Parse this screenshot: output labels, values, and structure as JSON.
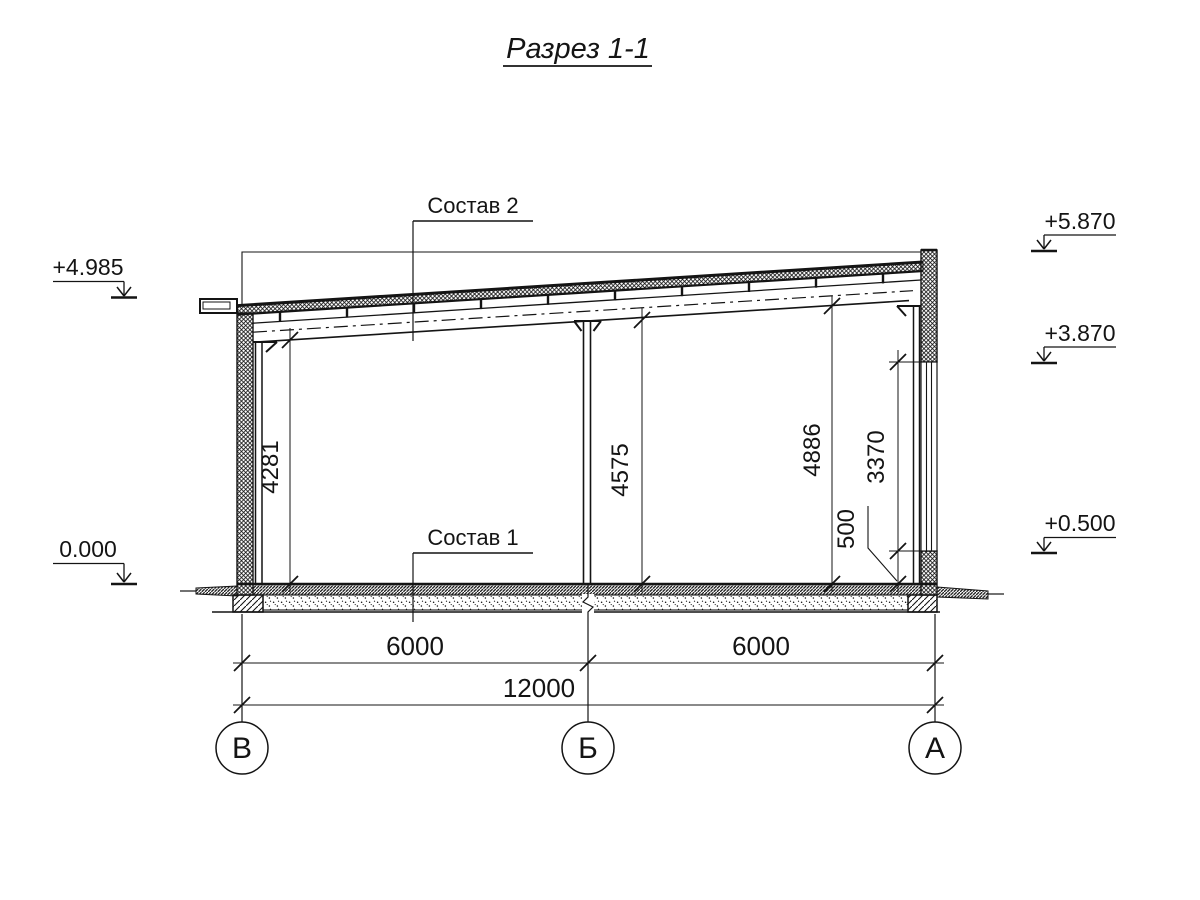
{
  "title": {
    "text": "Разрез 1-1"
  },
  "callouts": {
    "roof_assembly": "Состав 2",
    "floor_assembly": "Состав 1"
  },
  "elevations": {
    "left_eave": "+4.985",
    "ground_zero": "0.000",
    "right_parapet": "+5.870",
    "window_top": "+3.870",
    "window_sill": "+0.500"
  },
  "vertical_dimensions": {
    "left_clear_height": "4281",
    "middle_clear_height": "4575",
    "right_clear_height": "4886",
    "window_height": "3370",
    "sill_height": "500"
  },
  "horizontal_dimensions": {
    "bay_left": "6000",
    "bay_right": "6000",
    "total_span": "12000"
  },
  "axes": {
    "left": "В",
    "middle": "Б",
    "right": "А"
  }
}
